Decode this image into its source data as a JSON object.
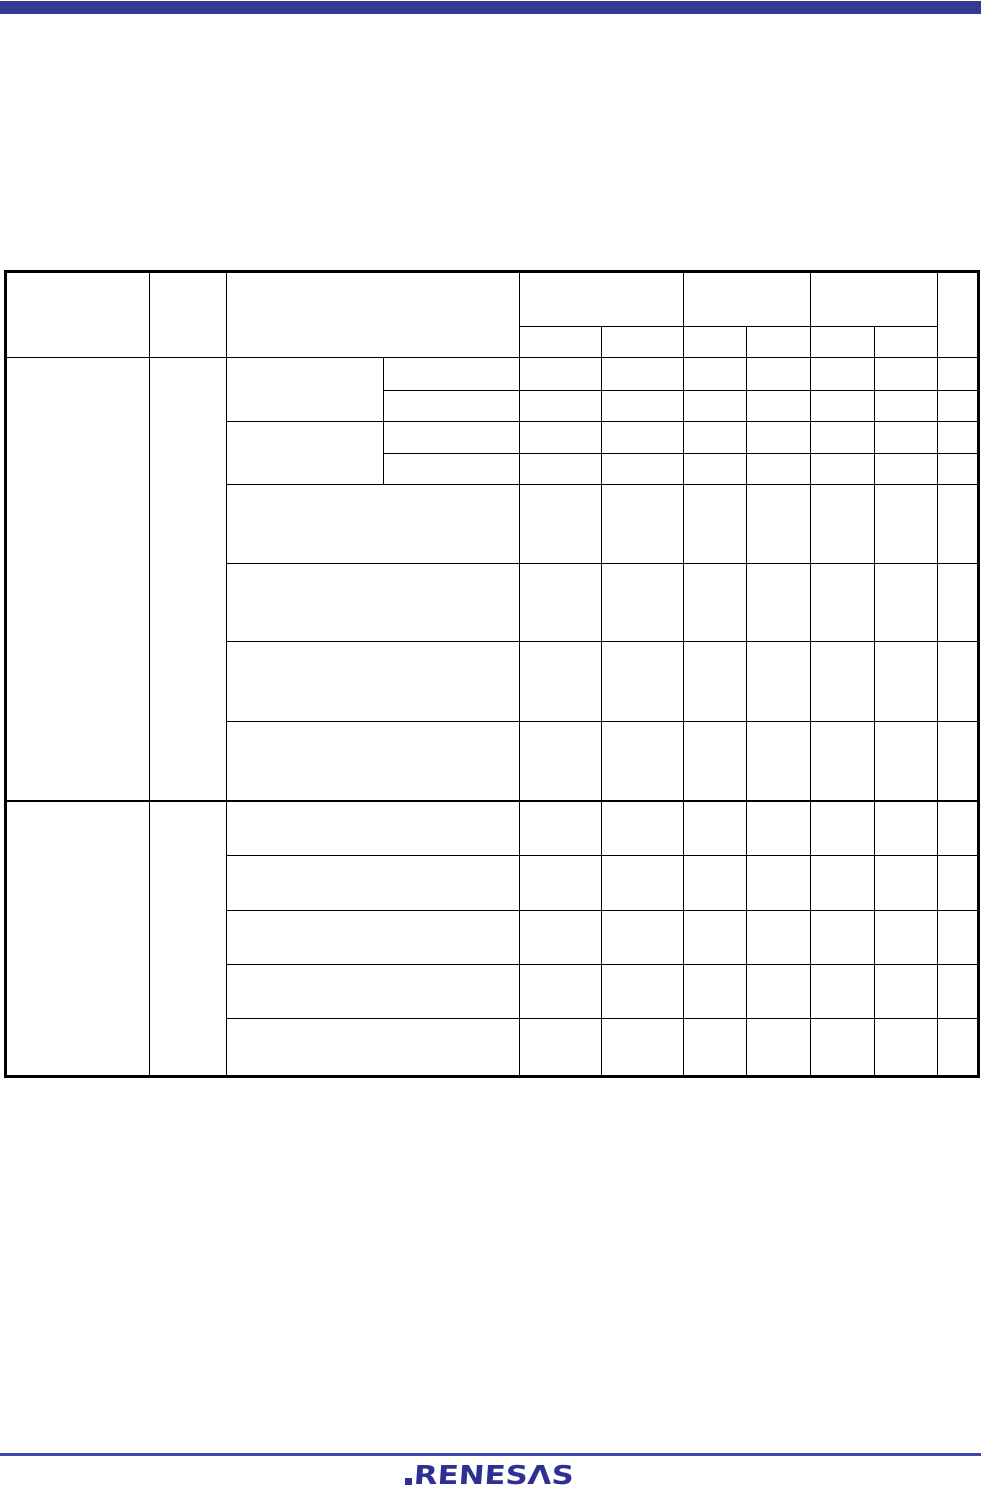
{
  "colors": {
    "page-bg": "#ffffff",
    "top-bar": "#323a94",
    "table-line": "#000000",
    "footer-rule": "#3a4aa8",
    "logo": "#2e3192"
  },
  "table": {
    "header": {
      "left_labels": [
        "",
        "",
        ""
      ],
      "group_labels": [
        "",
        "",
        ""
      ],
      "subcolumn_labels": [
        "",
        "",
        "",
        "",
        "",
        ""
      ],
      "last_column_label": ""
    }
  },
  "footer": {
    "logo_text": "RENESΛS"
  }
}
